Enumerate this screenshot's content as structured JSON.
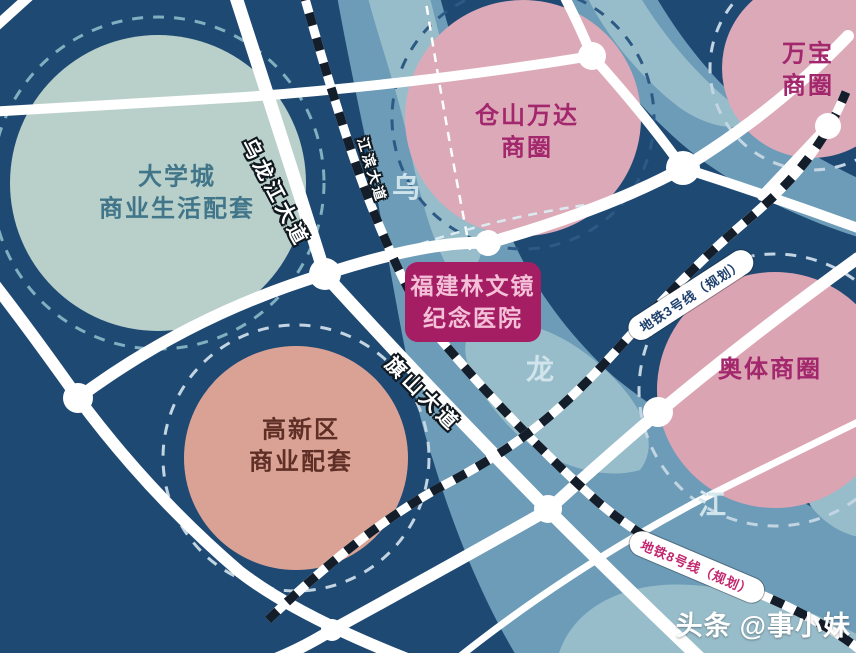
{
  "colors": {
    "background": "#1e4973",
    "river": "#6d9cb8",
    "river_light": "#98bdca",
    "road": "#ffffff",
    "railway_dark": "#141e2a",
    "zone_teal": "#b9cfc9",
    "zone_pink": "#dca9b8",
    "zone_salmon": "#d9a295",
    "hospital_fill": "#a51d63",
    "hospital_text": "#f3c0d8",
    "teal_text": "#41768a",
    "magenta_text": "#a3276d",
    "salmon_text": "#5f2f26",
    "metro3_text": "#1c3f6d",
    "metro8_text": "#c2266e",
    "river_char": "#d5e7ee"
  },
  "zones": [
    {
      "name": "daxuecheng",
      "line1": "大学城",
      "line2": "商业生活配套"
    },
    {
      "name": "cangshan-wanda",
      "line1": "仓山万达",
      "line2": "商圈"
    },
    {
      "name": "wanbao",
      "line1": "万宝",
      "line2": "商圈"
    },
    {
      "name": "aoti",
      "line1": "奥体商圈"
    },
    {
      "name": "gaoxin",
      "line1": "高新区",
      "line2": "商业配套"
    }
  ],
  "hospital": {
    "line1": "福建林文镜",
    "line2": "纪念医院"
  },
  "roads": [
    {
      "label": "乌龙江大道"
    },
    {
      "label": "江滨大道"
    },
    {
      "label": "旗山大道"
    }
  ],
  "metros": [
    {
      "label": "地铁3号线（规划）"
    },
    {
      "label": "地铁8号线（规划）"
    }
  ],
  "river_chars": [
    "乌",
    "龙",
    "江"
  ],
  "watermark": {
    "brand": "头条",
    "handle": "@事小妹"
  }
}
